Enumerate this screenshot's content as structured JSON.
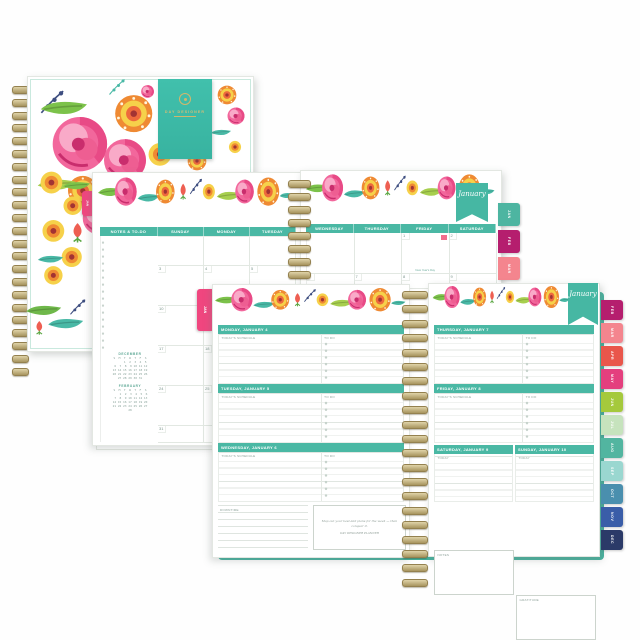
{
  "cover": {
    "brand": "DAY DESIGNER"
  },
  "monthly": {
    "side_tab": "JAN",
    "banner": "January",
    "headers_left": [
      "NOTES & TO-DO",
      "SUNDAY",
      "MONDAY",
      "TUESDAY"
    ],
    "headers_right": [
      "WEDNESDAY",
      "THURSDAY",
      "FRIDAY",
      "SATURDAY"
    ],
    "grid_left": [
      [
        "",
        "",
        ""
      ],
      [
        "3",
        "4",
        "5"
      ],
      [
        "10",
        "11",
        "12"
      ],
      [
        "17",
        "18",
        "19"
      ],
      [
        "24",
        "25",
        "26"
      ],
      [
        "31",
        "",
        ""
      ]
    ],
    "grid_right": [
      [
        "",
        "",
        "1",
        "2"
      ],
      [
        "6",
        "7",
        "8",
        "9"
      ],
      [
        "13",
        "14",
        "15",
        "16"
      ],
      [
        "20",
        "21",
        "22",
        "23"
      ],
      [
        "27",
        "28",
        "29",
        "30"
      ]
    ],
    "holiday_label": "New Year's Day",
    "mini_calendars": [
      {
        "title": "DECEMBER",
        "dow": "S  M  T  W  T  F  S",
        "rows": [
          "      1  2  3  4  5",
          " 6  7  8  9 10 11 12",
          "13 14 15 16 17 18 19",
          "20 21 22 23 24 25 26",
          "27 28 29 30 31"
        ]
      },
      {
        "title": "FEBRUARY",
        "dow": "S  M  T  W  T  F  S",
        "rows": [
          "    1  2  3  4  5  6",
          " 7  8  9 10 11 12 13",
          "14 15 16 17 18 19 20",
          "21 22 23 24 25 26 27",
          "28"
        ]
      }
    ],
    "tabs": [
      {
        "label": "JAN",
        "color": "#4db5a1"
      },
      {
        "label": "FEB",
        "color": "#b51e6e"
      },
      {
        "label": "MAR",
        "color": "#f4858e"
      },
      {
        "label": "APR",
        "color": "#e9564b"
      }
    ]
  },
  "weekly": {
    "side_tab": "JAN",
    "banner": "January",
    "schedule_label": "TODAY'S SCHEDULE",
    "todo_label": "TO DO",
    "today_label": "TODAY",
    "days_left": [
      "MONDAY, JANUARY 4",
      "TUESDAY, JANUARY 5",
      "WEDNESDAY, JANUARY 6"
    ],
    "days_right": [
      "THURSDAY, JANUARY 7",
      "FRIDAY, JANUARY 8"
    ],
    "weekend": [
      "SATURDAY, JANUARY 9",
      "SUNDAY, JANUARY 10"
    ],
    "footer": {
      "downtime_label": "DOWNTIME",
      "quote_line1": "Map out your best-laid plans for the week — then conquer it.",
      "quote_line2": "DAY DESIGNER PLANNER",
      "notes_label": "NOTES",
      "gratitude_label": "GRATITUDE"
    },
    "tabs": [
      {
        "label": "FEB",
        "color": "#b51e6e"
      },
      {
        "label": "MAR",
        "color": "#f4858e"
      },
      {
        "label": "APR",
        "color": "#e9564b"
      },
      {
        "label": "MAY",
        "color": "#e43f7e"
      },
      {
        "label": "JUN",
        "color": "#a5c93c"
      },
      {
        "label": "JUL",
        "color": "#c6e3bd"
      },
      {
        "label": "AUG",
        "color": "#52b5a0"
      },
      {
        "label": "SEP",
        "color": "#9ad7d0"
      },
      {
        "label": "OCT",
        "color": "#4a8fae"
      },
      {
        "label": "NOV",
        "color": "#3a5da8"
      },
      {
        "label": "DEC",
        "color": "#2b3a68"
      }
    ]
  },
  "colors": {
    "teal": "#4ab8a4",
    "gold_spiral": "#a8955f",
    "mint_trim": "#43b29e",
    "tab_pink": "#f0467f"
  }
}
